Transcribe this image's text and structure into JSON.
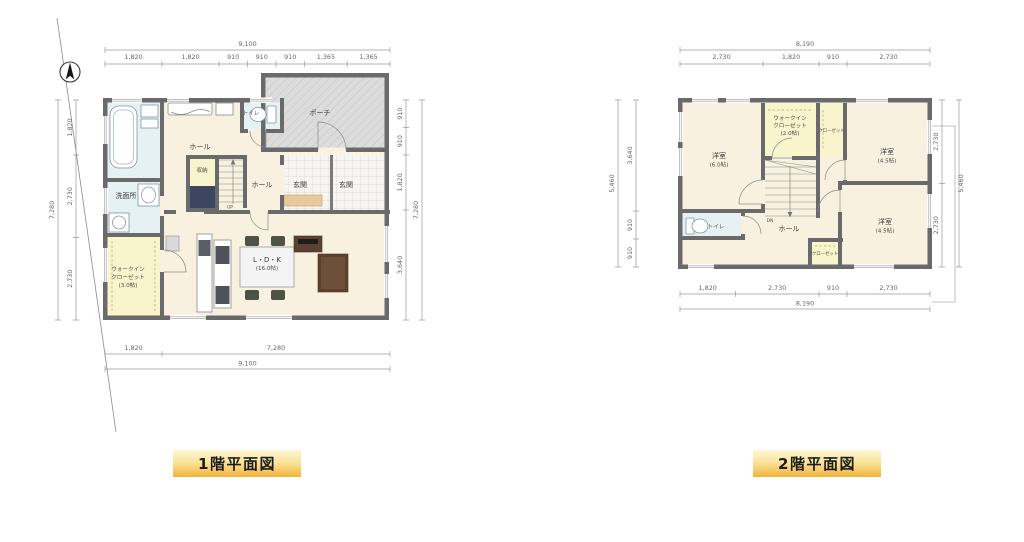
{
  "captions": {
    "floor1": "1階平面図",
    "floor2": "2階平面図"
  },
  "colors": {
    "wall": "#6a6a6a",
    "floor_cream": "#f9f1e0",
    "wet_area_blue": "#e6f1f4",
    "closet_yellow": "#f8f4cb",
    "porch_gray": "#dcdcdc",
    "entry_step_tan": "#e9c99b",
    "stair_void_navy": "#3d4660",
    "caption_gradient_top": "#fdf6d6",
    "caption_gradient_bottom": "#f3b23c",
    "dimension_gray": "#9a9a9a"
  },
  "plan1": {
    "dims_top": {
      "total": "9,100",
      "segments": [
        "1,820",
        "1,820",
        "910",
        "910",
        "910",
        "1,365",
        "1,365"
      ]
    },
    "dims_bottom": {
      "segments": [
        "1,820",
        "7,280"
      ],
      "total": "9,100"
    },
    "dims_left": {
      "total": "7,280",
      "segments": [
        "1,820",
        "2,730",
        "2,730"
      ]
    },
    "dims_right": {
      "total": "7,280",
      "segments": [
        "910",
        "910",
        "1,820",
        "3,640"
      ]
    },
    "rooms": {
      "porch": "ポーチ",
      "toilet": "トイレ",
      "hall_upper": "ホール",
      "storage": "収納",
      "hall_entry": "ホール",
      "entrance": "玄関",
      "entrance2": "玄関",
      "washroom": "洗面所",
      "wic_line1": "ウォークイン",
      "wic_line2": "クローゼット",
      "wic_area": "(3.0帖)",
      "ldk": "L・D・K",
      "ldk_area": "(16.0帖)",
      "stairs": "UP"
    }
  },
  "plan2": {
    "dims_top": {
      "total": "8,190",
      "segments": [
        "2,730",
        "1,820",
        "910",
        "2,730"
      ]
    },
    "dims_bottom": {
      "segments": [
        "1,820",
        "2,730",
        "910",
        "2,730"
      ],
      "total": "8,190"
    },
    "dims_left": {
      "total": "5,460",
      "segments": [
        "3,640",
        "910",
        "910"
      ]
    },
    "dims_right": {
      "total": "5,460",
      "segments": [
        "2,730",
        "2,730"
      ]
    },
    "rooms": {
      "bedroom_main": "洋室",
      "bedroom_main_area": "(6.0帖)",
      "wic_line1": "ウォークイン",
      "wic_line2": "クローゼット",
      "wic_area": "(2.0帖)",
      "closet_top": "クローゼット",
      "bedroom2": "洋室",
      "bedroom2_area": "(4.5帖)",
      "bedroom3": "洋室",
      "bedroom3_area": "(4.5帖)",
      "closet_bottom": "クローゼット",
      "toilet": "トイレ",
      "hall": "ホール",
      "stairs": "DN"
    }
  }
}
